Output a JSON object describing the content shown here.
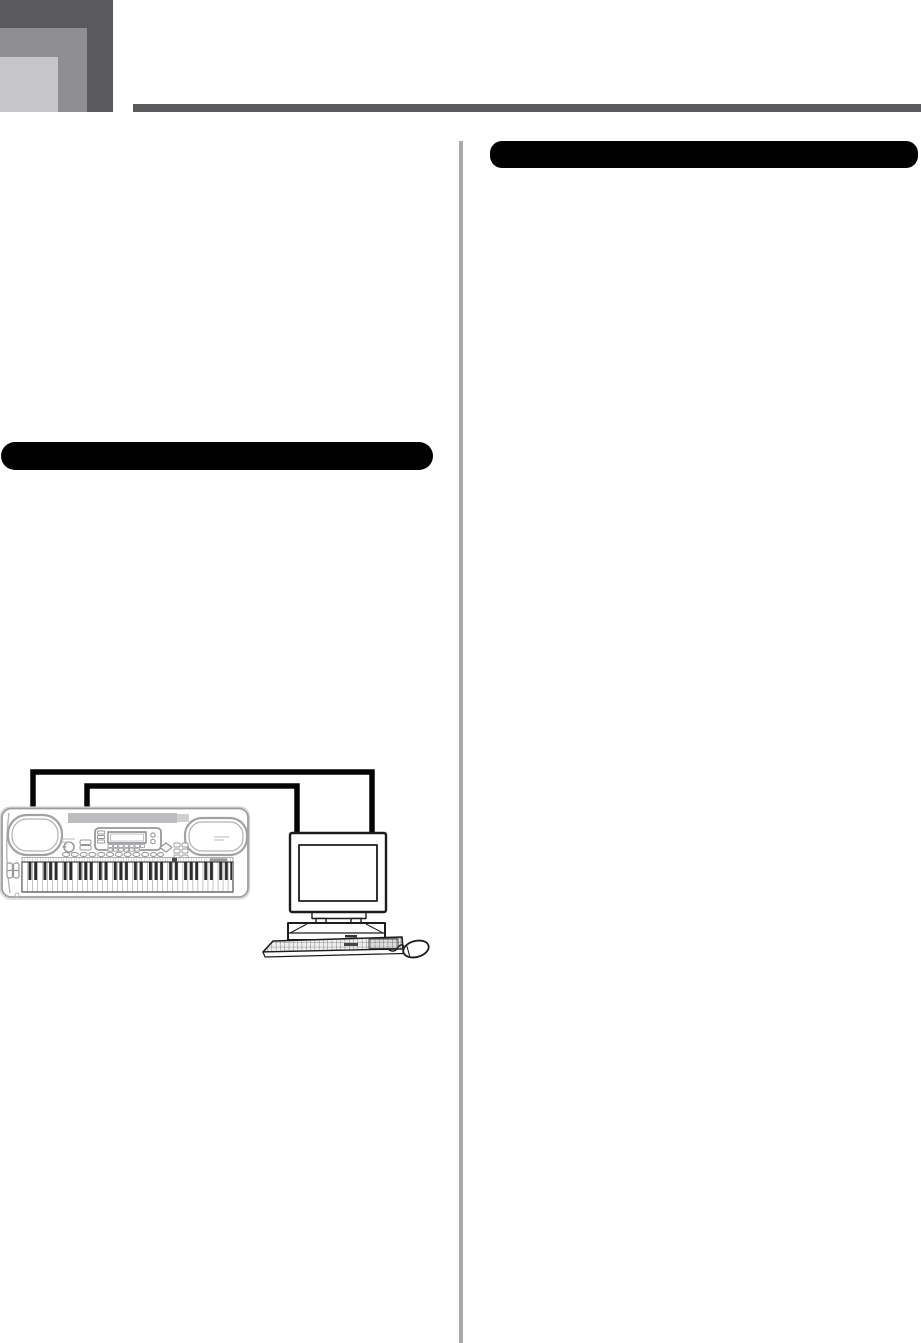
{
  "page": {
    "kind": "scanned manual page",
    "background": "#ffffff"
  },
  "header": {
    "logo_squares": [
      {
        "name": "dark",
        "color": "#5a5a5c"
      },
      {
        "name": "medium",
        "color": "#8f8f91"
      },
      {
        "name": "light",
        "color": "#c6c6c8"
      }
    ],
    "rule_color": "#5a5a5c"
  },
  "layout": {
    "columns": 2,
    "divider_color": "#a9a9ab"
  },
  "sections": {
    "left_heading_bar": {
      "title": "",
      "color": "#000000"
    },
    "right_heading_bar": {
      "title": "",
      "color": "#000000"
    }
  },
  "illustration": {
    "name": "keyboard-connected-to-computer",
    "depicts": "electronic music keyboard linked to a desktop computer by two cables",
    "parts": [
      "music-keyboard",
      "midi-cable-outer",
      "midi-cable-inner",
      "crt-monitor",
      "desktop-case",
      "pc-keyboard",
      "mouse"
    ],
    "cable_color": "#050505",
    "keyboard_line_color": "#a2a2a4",
    "computer_line_color": "#1c1c1c"
  }
}
